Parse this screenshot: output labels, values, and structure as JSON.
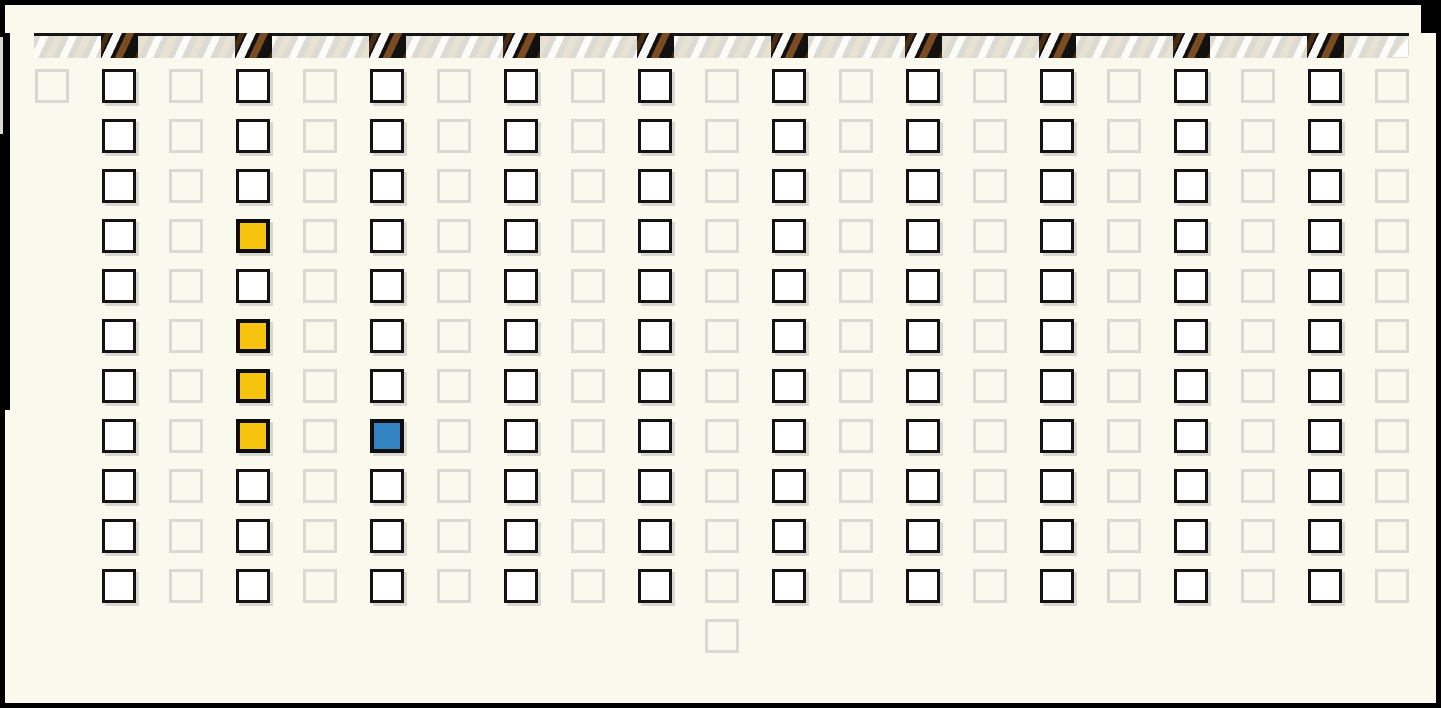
{
  "app": {
    "description": "pattern board with timeline bar and toggle-cell grid",
    "background_color": "#FAF9EE",
    "frame_color": "#000000"
  },
  "timeline": {
    "base_color": "#DBDBD4",
    "stripe_white": "#FBFBF8",
    "stripe_beige": "#E8E2D2",
    "marker_background": "#131110",
    "marker_stripe_white": "#F8F8F6",
    "marker_stripe_brown": "#7B4B22",
    "marker_stripe_dark_brown": "#4A2E14",
    "marker_columns": [
      1,
      3,
      5,
      7,
      9,
      11,
      13,
      15,
      17,
      19
    ]
  },
  "board": {
    "columns": 21,
    "rows": 12,
    "origin_x": 35,
    "origin_y": 69,
    "col_pitch": 67,
    "row_pitch": 50,
    "cell_size": 34,
    "active_columns": [
      1,
      3,
      5,
      7,
      9,
      11,
      13,
      15,
      17,
      19
    ],
    "row_columns": [
      {
        "row": 1,
        "cols": "0-20"
      },
      {
        "row": 2,
        "cols": "1-20"
      },
      {
        "row": 3,
        "cols": "1-20"
      },
      {
        "row": 4,
        "cols": "1-20"
      },
      {
        "row": 5,
        "cols": "1-20"
      },
      {
        "row": 6,
        "cols": "1-20"
      },
      {
        "row": 7,
        "cols": "1-20"
      },
      {
        "row": 8,
        "cols": "1-20"
      },
      {
        "row": 9,
        "cols": "1-20"
      },
      {
        "row": 10,
        "cols": "1-20"
      },
      {
        "row": 11,
        "cols": "1-20"
      },
      {
        "row": 12,
        "cols": "10"
      }
    ]
  },
  "cells": {
    "active_fill": "#FFFFFF",
    "active_border": "#131313",
    "inactive_border": "#D9D9D2",
    "shadow_color": "#D8D8D0",
    "filled": [
      {
        "col": 3,
        "row": 4,
        "color": "#F7C40D",
        "name": "yellow"
      },
      {
        "col": 3,
        "row": 6,
        "color": "#F7C40D",
        "name": "yellow"
      },
      {
        "col": 3,
        "row": 7,
        "color": "#F7C40D",
        "name": "yellow"
      },
      {
        "col": 3,
        "row": 8,
        "color": "#F7C40D",
        "name": "yellow"
      },
      {
        "col": 5,
        "row": 8,
        "color": "#3383C2",
        "name": "blue"
      }
    ]
  }
}
